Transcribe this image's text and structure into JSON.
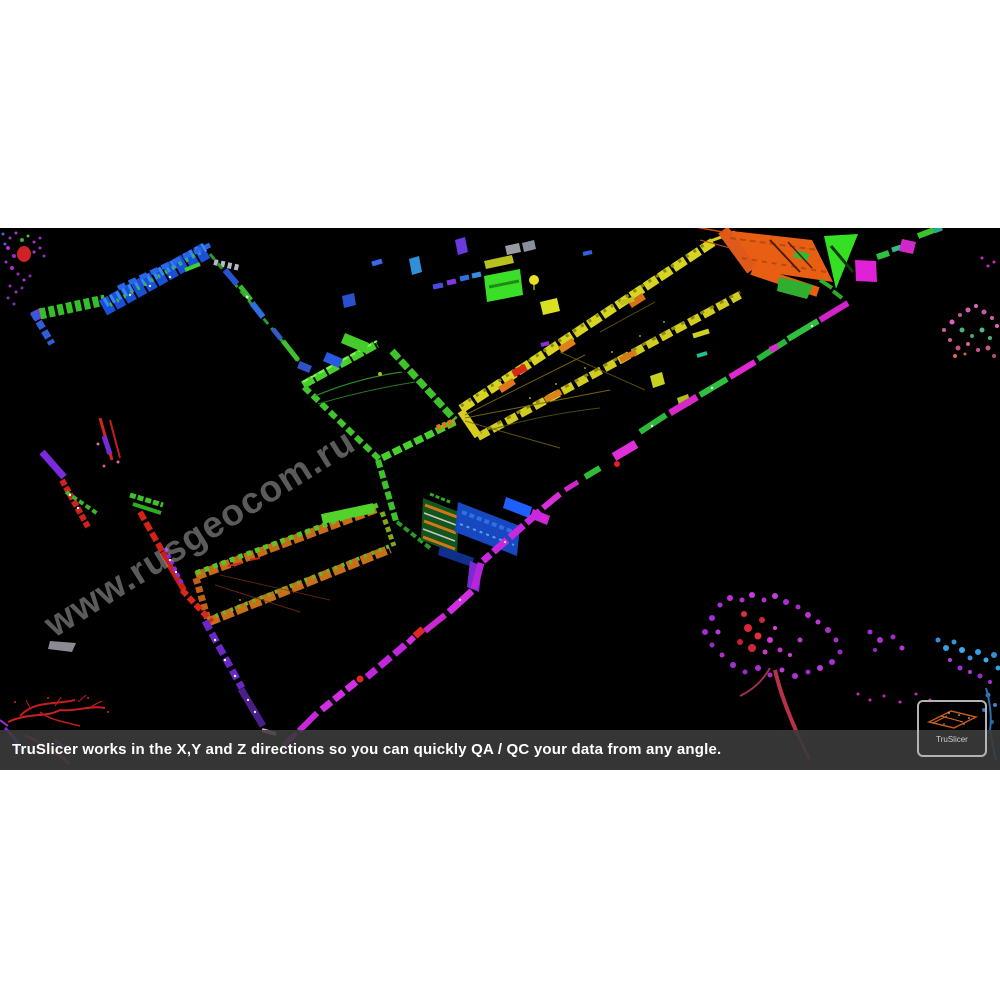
{
  "viewer": {
    "background": "#000000"
  },
  "watermark": {
    "text": "www.rusgeocom.ru",
    "color": "#a5a5a5"
  },
  "caption": {
    "text": "TruSlicer works in the X,Y and Z directions so you can quickly QA / QC your data from any angle.",
    "bar_color": "#3c3c3c",
    "text_color": "#ffffff"
  },
  "thumbnail": {
    "label": "TruSlicer",
    "border_color": "#b3b3b3"
  },
  "palette": {
    "wall_blue": "#2a50d0",
    "wall_green": "#46d22a",
    "wall_yellow": "#d8d422",
    "wall_orange": "#e85f14",
    "wall_magenta": "#e02fd8",
    "wall_purple": "#7a2be0",
    "wall_red": "#d42418",
    "tree_purple": "#b030d0",
    "tree_pink": "#e060b8",
    "tree_blue": "#3090e0"
  }
}
